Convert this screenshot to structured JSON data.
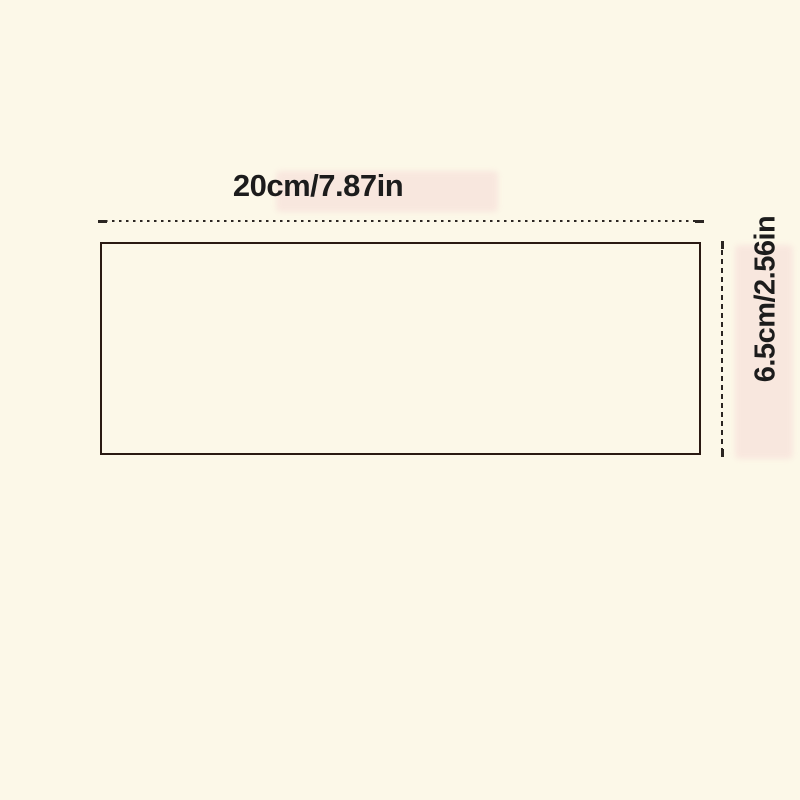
{
  "diagram": {
    "width_label": "20cm/7.87in",
    "height_label": "6.5cm/2.56in"
  },
  "colors": {
    "background": "#FCF8E8",
    "highlight": "#F8E3DC",
    "outline": "#2A1A12",
    "dimension_line": "#2B2622",
    "text": "#1C1C1C"
  }
}
